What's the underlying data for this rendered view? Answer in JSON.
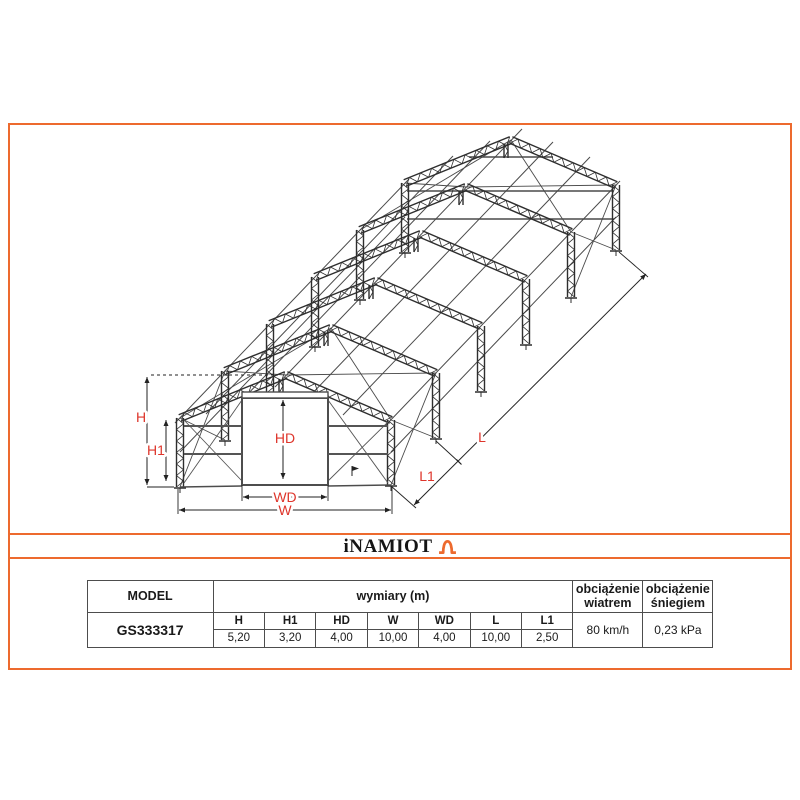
{
  "brand": {
    "name": "iNAMIOT"
  },
  "diagram": {
    "labels": {
      "H": "H",
      "H1": "H1",
      "HD": "HD",
      "WD": "WD",
      "W": "W",
      "L": "L",
      "L1": "L1"
    }
  },
  "table": {
    "model_label": "MODEL",
    "dims_label": "wymiary (m)",
    "wind_label": "obciążenie\nwiatrem",
    "snow_label": "obciążenie\nśniegiem",
    "model_value": "GS333317",
    "dim_headers": [
      "H",
      "H1",
      "HD",
      "W",
      "WD",
      "L",
      "L1"
    ],
    "dim_values": [
      "5,20",
      "3,20",
      "4,00",
      "10,00",
      "4,00",
      "10,00",
      "2,50"
    ],
    "wind_value": "80 km/h",
    "snow_value": "0,23 kPa"
  },
  "colors": {
    "accent_orange": "#ED6A2E",
    "dimension_red": "#DE352B"
  }
}
